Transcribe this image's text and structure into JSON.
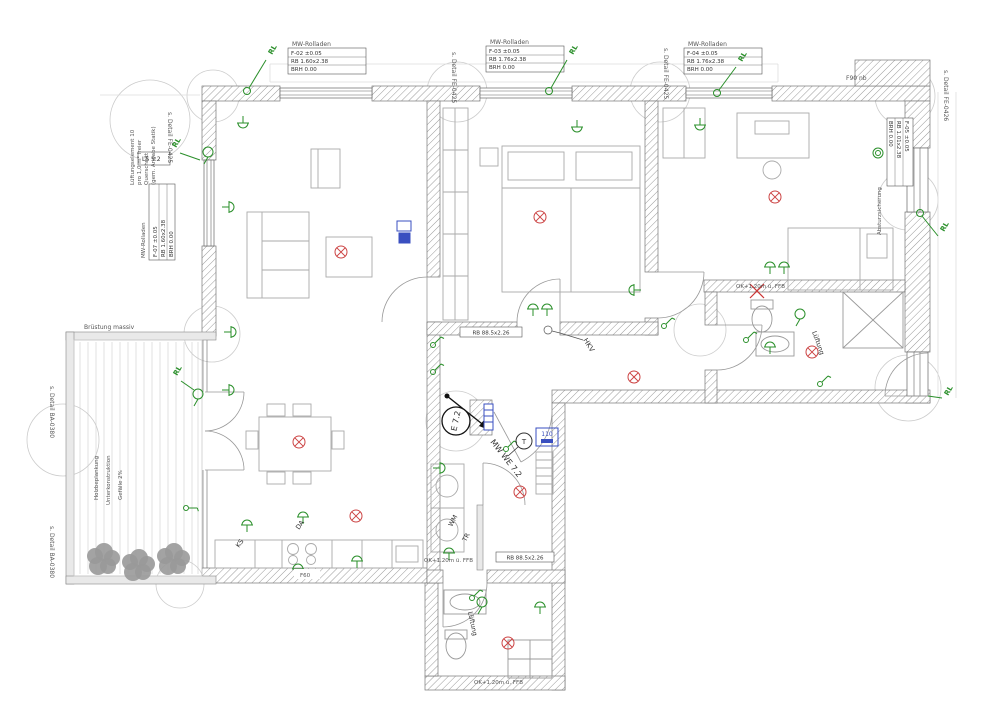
{
  "t": {
    "rl": "RL",
    "rolladen": "MW-Rolladen",
    "tagA1": "F-02 ±0.05",
    "tagA2": "RB 1.60x2.38",
    "tagA3": "BRH 0.00",
    "tagB1": "F-03 ±0.05",
    "tagB2": "RB 1.76x2.38",
    "tagB3": "BRH 0.00",
    "tagC1": "F-04 ±0.05",
    "tagC2": "RB 1.76x2.38",
    "tagC3": "BRH 0.00",
    "tagL0": "MW-Rolladen",
    "tagL1": "F-07 ±0.05",
    "tagL2": "RB 1.60x2.38",
    "tagL3": "BRH 0.00",
    "tagR1": "F-05 ±0.05",
    "tagR2": "RB 1.01x2.38",
    "tagR3": "BRH 0.00",
    "ls": "LS 5.2",
    "fe0425": "s. Detail FE-0425",
    "fe0426": "s. Detail FE-0426",
    "ba0380": "s. Detail BA-0380",
    "f90": "F90 nb",
    "f60": "F60",
    "bruestung": "Brüstung massiv",
    "hkv": "HKV",
    "e72": "E 7.2",
    "we72": "MW WE 7.2",
    "tt": "T",
    "v110": "110",
    "ks": "KS",
    "da": "DA",
    "wm": "WM",
    "tr": "TR",
    "lueftung": "Lüftung",
    "ok120": "OK+1.20m ü. FFB",
    "doortag": "RB 88.5x2.26",
    "noteL1": "Lüftungselement 10",
    "noteL2": "pro 1,0 m² freier",
    "noteL3": "Querschnitt",
    "noteL4": "(gem. Angabe Statik)",
    "balc1": "Holzbeplankung",
    "balc2": "Unterkonstruktion",
    "balc3": "Gefälle 2%",
    "absturz": "Absturzsicherung"
  },
  "symbols": {
    "ceiling_light": "red-crossed-circle",
    "socket": "green-trident",
    "switch": "green-circle-with-stroke",
    "vent": "green-circle-with-stem",
    "demolition_mark": "red-x",
    "entry_tag": "circle-E-7.2"
  },
  "colors": {
    "symbol_green": "#2a8f2a",
    "symbol_red": "#cc4444",
    "symbol_blue": "#3a4fc0",
    "wall_hatch": "#9a9a9a",
    "line_gray": "#888888",
    "tree_gray": "#999999"
  }
}
